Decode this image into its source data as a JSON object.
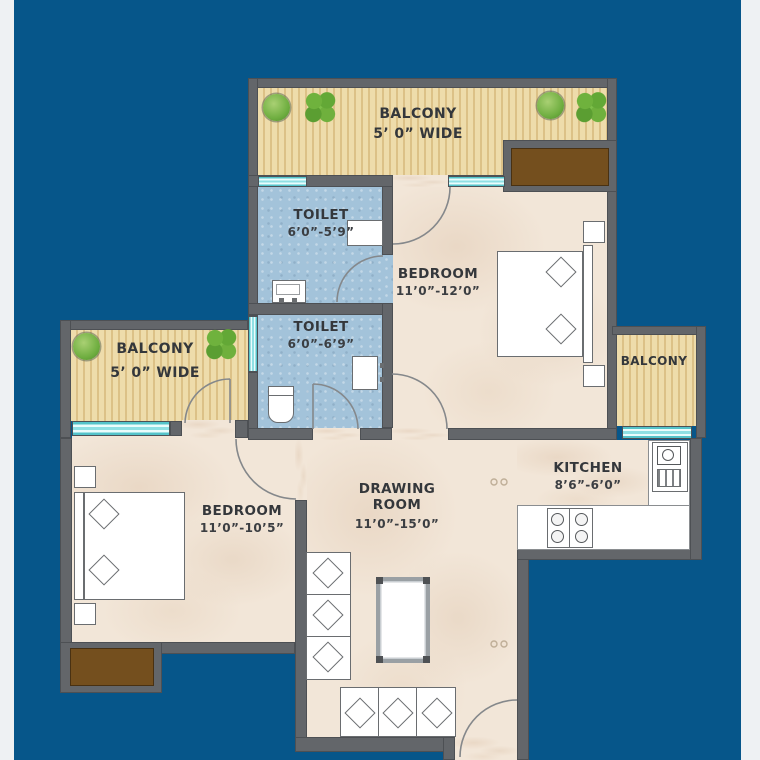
{
  "plan_title": "2BHK apartment floor plan",
  "rooms": {
    "balcony_top": {
      "label": "BALCONY",
      "dimension": "5’ 0” WIDE"
    },
    "toilet_top": {
      "label": "TOILET",
      "dimension": "6’0”-5’9”"
    },
    "toilet_mid": {
      "label": "TOILET",
      "dimension": "6’0”-6’9”"
    },
    "bedroom_top": {
      "label": "BEDROOM",
      "dimension": "11’0”-12’0”"
    },
    "balcony_left": {
      "label": "BALCONY",
      "dimension": "5’ 0” WIDE"
    },
    "balcony_right": {
      "label": "BALCONY"
    },
    "bedroom_left": {
      "label": "BEDROOM",
      "dimension": "11’0”-10’5”"
    },
    "drawing_room": {
      "label_line1": "DRAWING",
      "label_line2": "ROOM",
      "dimension": "11’0”-15’0”"
    },
    "kitchen": {
      "label": "KITCHEN",
      "dimension": "8’6”-6’0”"
    }
  },
  "colors": {
    "background_blue": "#06568a",
    "edge_strip": "#eef1f3",
    "wall_gray": "#63666a",
    "room_floor_beige": "#f2e6d8",
    "balcony_floor_tan": "#eedcab",
    "toilet_floor_blue": "#a3c3da",
    "window_cyan": "#8fe0e4",
    "wardrobe_brown": "#744f1e",
    "plant_green": "#6fae40",
    "label_text": "#34373b"
  }
}
